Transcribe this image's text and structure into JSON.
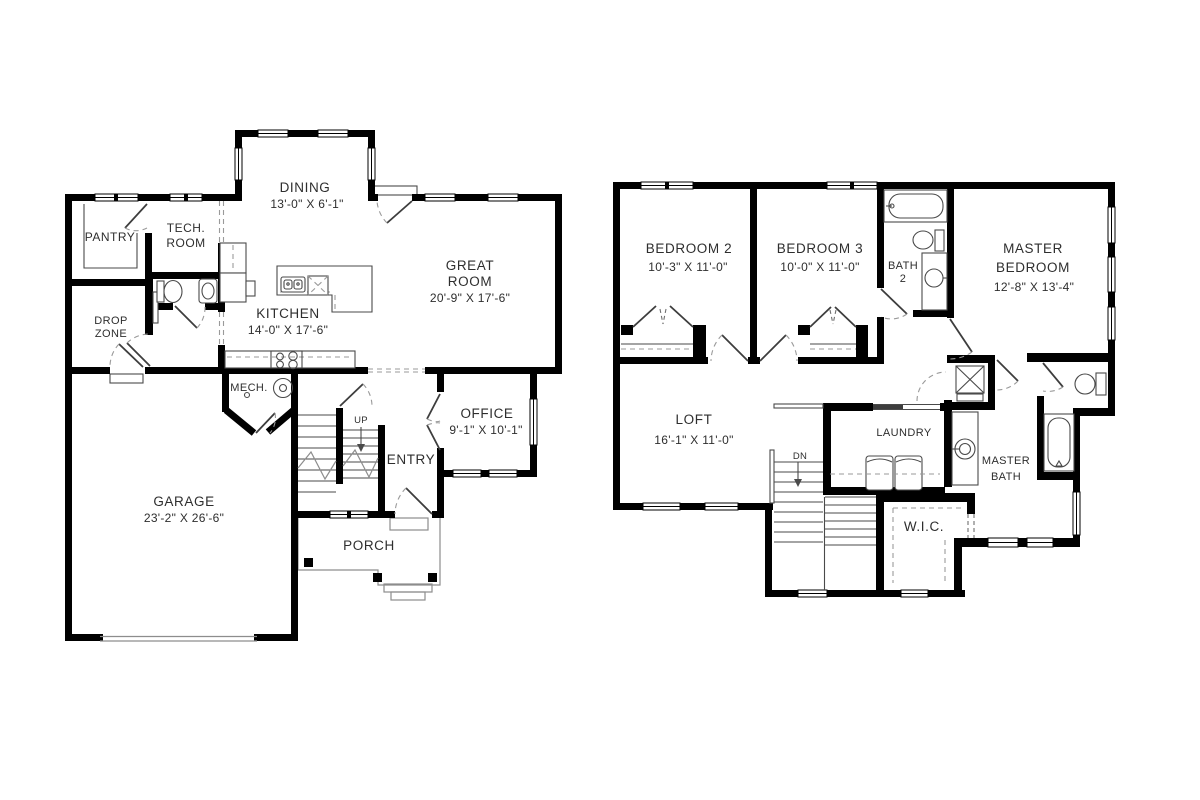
{
  "document": {
    "type": "floor-plan",
    "background": "#ffffff"
  },
  "colors": {
    "wall": "#000000",
    "fixture_line": "#4a4a4a",
    "dash_line": "#9a9a9a",
    "text": "#2e2e2e"
  },
  "floor1": {
    "rooms": {
      "pantry": {
        "name": "PANTRY"
      },
      "tech_room": {
        "name_line1": "TECH.",
        "name_line2": "ROOM"
      },
      "dining": {
        "name": "DINING",
        "dims": "13'-0\" X 6'-1\""
      },
      "great_room": {
        "name_line1": "GREAT",
        "name_line2": "ROOM",
        "dims": "20'-9\" X 17'-6\""
      },
      "kitchen": {
        "name": "KITCHEN",
        "dims": "14'-0\" X 17'-6\""
      },
      "drop_zone": {
        "name_line1": "DROP",
        "name_line2": "ZONE"
      },
      "mech": {
        "name": "MECH."
      },
      "office": {
        "name": "OFFICE",
        "dims": "9'-1\" X 10'-1\""
      },
      "entry": {
        "name": "ENTRY"
      },
      "garage": {
        "name": "GARAGE",
        "dims": "23'-2\" X 26'-6\""
      },
      "porch": {
        "name": "PORCH"
      },
      "stairs": {
        "label": "UP"
      }
    }
  },
  "floor2": {
    "rooms": {
      "bedroom2": {
        "name": "BEDROOM 2",
        "dims": "10'-3\" X 11'-0\""
      },
      "bedroom3": {
        "name": "BEDROOM 3",
        "dims": "10'-0\" X 11'-0\""
      },
      "bath2": {
        "name_line1": "BATH",
        "name_line2": "2"
      },
      "master_bedroom": {
        "name_line1": "MASTER",
        "name_line2": "BEDROOM",
        "dims": "12'-8\" X 13'-4\""
      },
      "loft": {
        "name": "LOFT",
        "dims": "16'-1\" X 11'-0\""
      },
      "laundry": {
        "name": "LAUNDRY"
      },
      "master_bath": {
        "name_line1": "MASTER",
        "name_line2": "BATH"
      },
      "wic": {
        "name": "W.I.C."
      },
      "stairs": {
        "label": "DN"
      }
    }
  }
}
